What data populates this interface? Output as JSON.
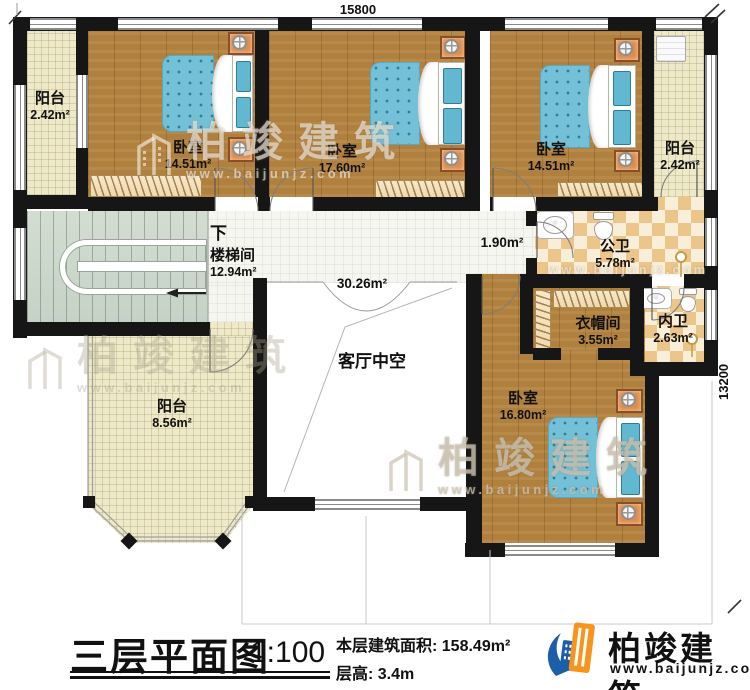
{
  "title_block": {
    "plan_title": "三层平面图",
    "scale": "1:100",
    "floor_area": "本层建筑面积: 158.49m²",
    "floor_height": "层高: 3.4m"
  },
  "brand": {
    "name": "柏竣建筑",
    "website": "www.baijunjz.com"
  },
  "watermark": {
    "name": "柏竣建筑",
    "website": "www.baijunjz.com"
  },
  "dimensions": {
    "width": "15800",
    "height": "13200"
  },
  "rooms": [
    {
      "id": "balcony-top-left",
      "name": "阳台",
      "area": "2.42m²"
    },
    {
      "id": "bedroom-top-left",
      "name": "卧室",
      "area": "14.51m²"
    },
    {
      "id": "bedroom-top-mid",
      "name": "卧室",
      "area": "17.60m²"
    },
    {
      "id": "bedroom-top-right",
      "name": "卧室",
      "area": "14.51m²"
    },
    {
      "id": "balcony-top-right",
      "name": "阳台",
      "area": "2.42m²"
    },
    {
      "id": "hallway",
      "name": "",
      "area": "1.90m²"
    },
    {
      "id": "public-bath",
      "name": "公卫",
      "area": "5.78m²"
    },
    {
      "id": "stairwell",
      "name": "楼梯间",
      "area": "12.94m²",
      "direction": "下"
    },
    {
      "id": "living-void",
      "name": "客厅中空",
      "area": "30.26m²"
    },
    {
      "id": "cloakroom",
      "name": "衣帽间",
      "area": "3.55m²"
    },
    {
      "id": "private-bath",
      "name": "内卫",
      "area": "2.63m²"
    },
    {
      "id": "bedroom-bottom",
      "name": "卧室",
      "area": "16.80m²"
    },
    {
      "id": "balcony-left",
      "name": "阳台",
      "area": "8.56m²"
    }
  ],
  "colors": {
    "wall": "#161616",
    "wood_floor": "#b0803e",
    "balcony_tile": "#eee9c8",
    "hall_tile": "#f6f6f0",
    "bath_checker": "#ecc58a",
    "stair": "#ccd7cc",
    "bed_mattress": "#74c0d6",
    "nightstand": "#dd8c4c",
    "logo_blue": "#1c5fa8",
    "logo_orange": "#f7941e"
  }
}
